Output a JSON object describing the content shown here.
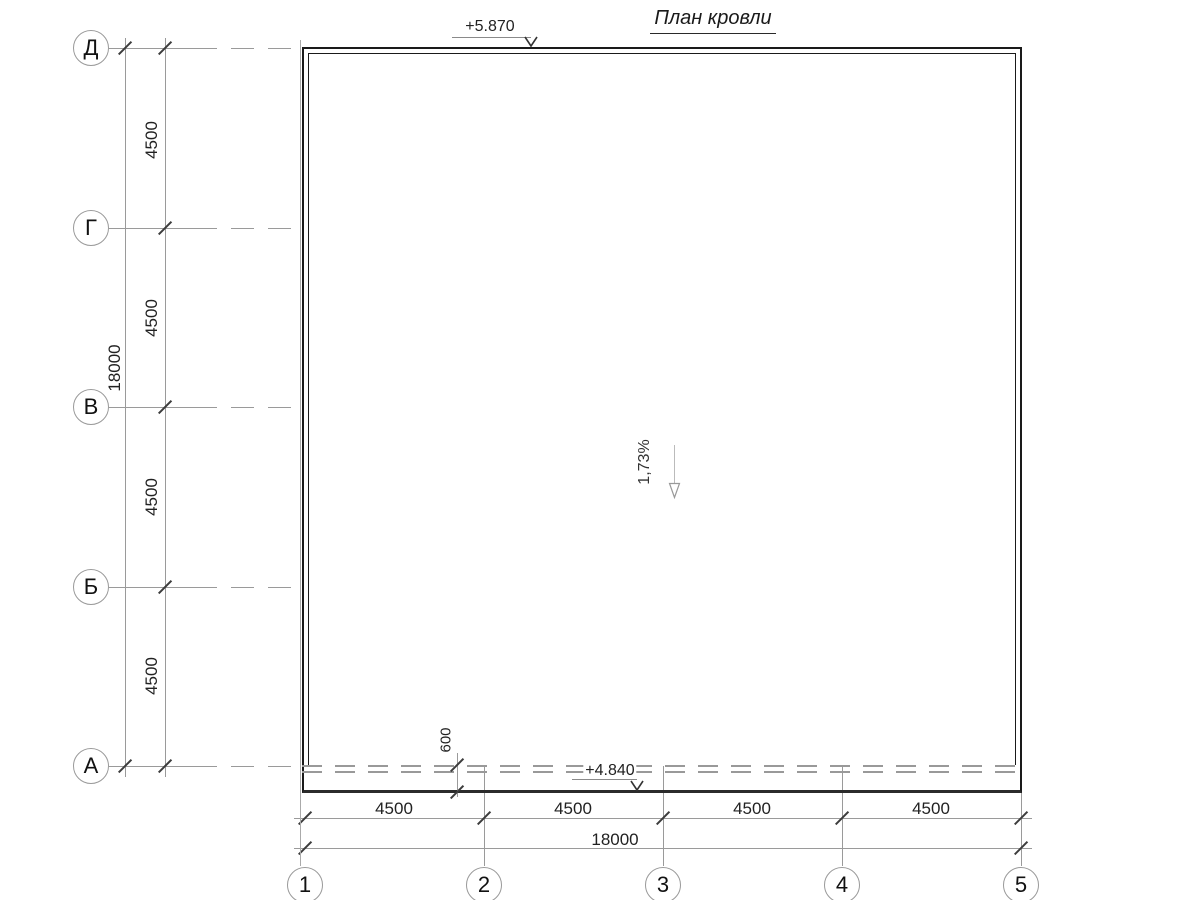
{
  "title": "План кровли",
  "annotations": {
    "elevation_top": "+5.870",
    "elevation_bottom": "+4.840",
    "slope": "1,73%",
    "overhang": "600"
  },
  "axes": {
    "rows": [
      {
        "label": "Д"
      },
      {
        "label": "Г"
      },
      {
        "label": "В"
      },
      {
        "label": "Б"
      },
      {
        "label": "А"
      }
    ],
    "cols": [
      {
        "label": "1"
      },
      {
        "label": "2"
      },
      {
        "label": "3"
      },
      {
        "label": "4"
      },
      {
        "label": "5"
      }
    ]
  },
  "dimensions": {
    "left": {
      "segments": [
        "4500",
        "4500",
        "4500",
        "4500"
      ],
      "total": "18000"
    },
    "bottom": {
      "segments": [
        "4500",
        "4500",
        "4500",
        "4500"
      ],
      "total": "18000"
    }
  }
}
